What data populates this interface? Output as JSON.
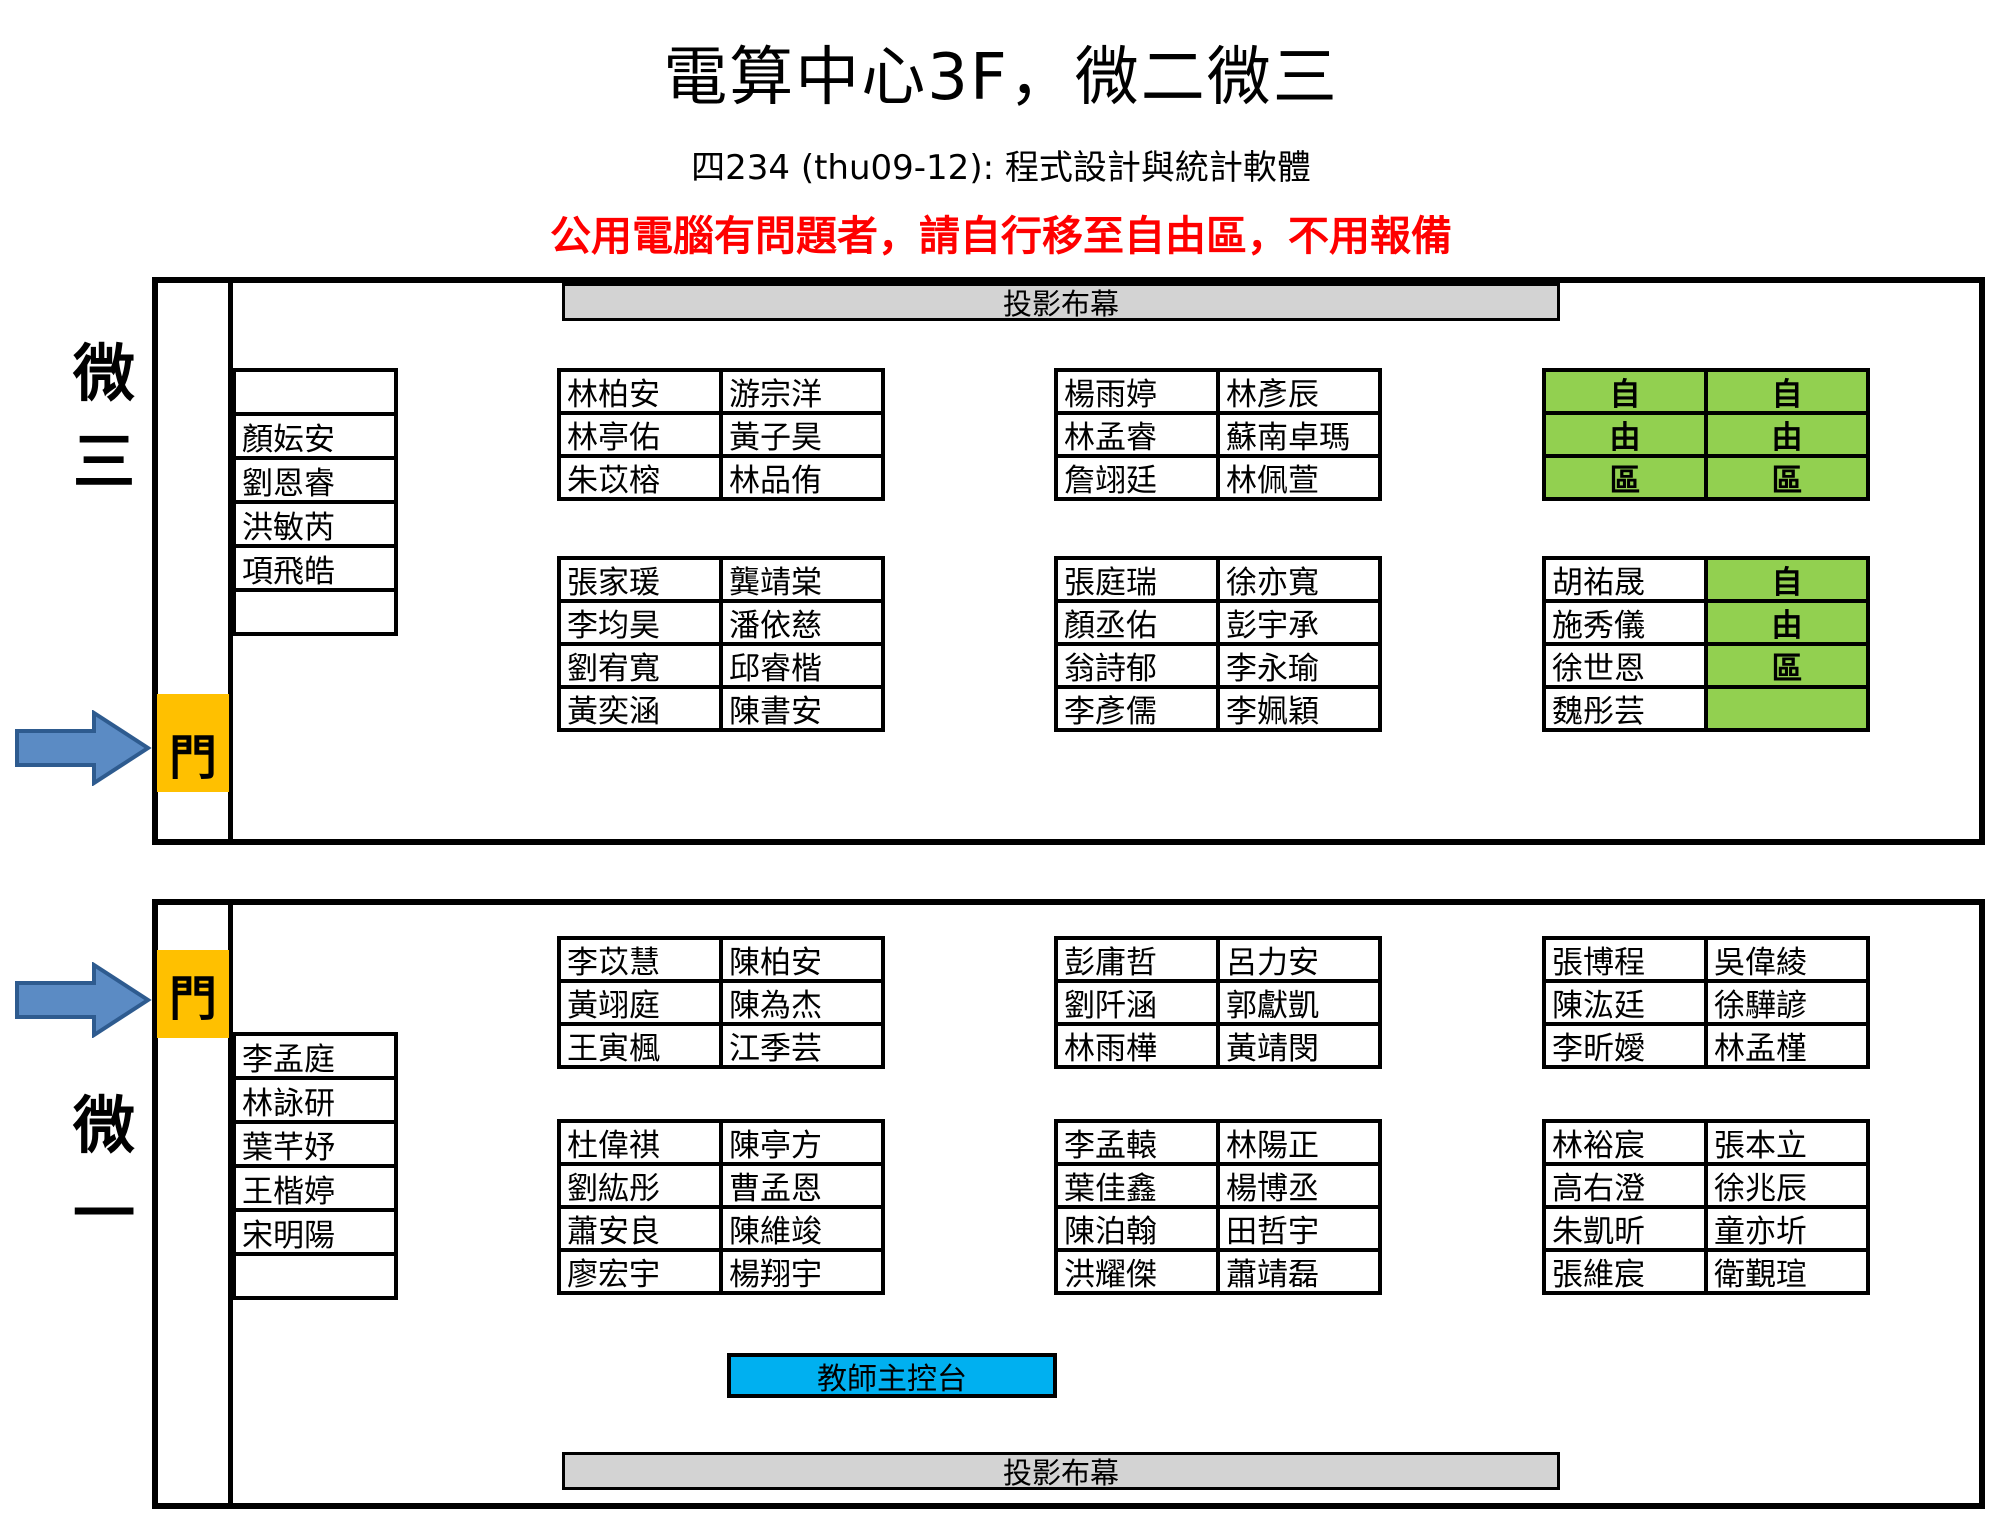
{
  "header": {
    "title": "電算中心3F，微二微三",
    "subtitle": "四234 (thu09-12): 程式設計與統計軟體",
    "notice": "公用電腦有問題者，請自行移至自由區，不用報備"
  },
  "labels": {
    "screen": "投影布幕",
    "door": "門",
    "console": "教師主控台",
    "room_top": "微三",
    "room_bottom": "微一"
  },
  "colors": {
    "free_area_green": "#92D050",
    "door_orange": "#FFC000",
    "console_blue": "#00B0F0",
    "screen_gray": "#D3D3D3",
    "notice_red": "#FF0000",
    "arrow_fill_blue": "#5B8BC4",
    "arrow_border_blue": "#2E5B8F"
  },
  "room_top": {
    "name": "微三",
    "left_column": [
      "",
      "顏妘安",
      "劉恩睿",
      "洪敏芮",
      "項飛皓",
      ""
    ],
    "free_marks": {
      "front_right": "all",
      "back_right": "col2"
    },
    "blocks": {
      "front_left": [
        [
          "林柏安",
          "游宗洋"
        ],
        [
          "林亭佑",
          "黃子昊"
        ],
        [
          "朱苡榕",
          "林品侑"
        ]
      ],
      "front_middle": [
        [
          "楊雨婷",
          "林彥辰"
        ],
        [
          "林孟睿",
          "蘇南卓瑪"
        ],
        [
          "詹翊廷",
          "林佩萱"
        ]
      ],
      "front_right": [
        [
          "自",
          "自"
        ],
        [
          "由",
          "由"
        ],
        [
          "區",
          "區"
        ]
      ],
      "back_left": [
        [
          "張家瑗",
          "龔靖棠"
        ],
        [
          "李均昊",
          "潘依慈"
        ],
        [
          "劉宥寬",
          "邱睿楷"
        ],
        [
          "黃奕涵",
          "陳書安"
        ]
      ],
      "back_middle": [
        [
          "張庭瑞",
          "徐亦寬"
        ],
        [
          "顏丞佑",
          "彭宇承"
        ],
        [
          "翁詩郁",
          "李永瑜"
        ],
        [
          "李彥儒",
          "李姵穎"
        ]
      ],
      "back_right": [
        [
          "胡祐晟",
          "自"
        ],
        [
          "施秀儀",
          "由"
        ],
        [
          "徐世恩",
          "區"
        ],
        [
          "魏彤芸",
          ""
        ]
      ]
    }
  },
  "room_bottom": {
    "name": "微一",
    "left_column": [
      "李孟庭",
      "林詠研",
      "葉芊妤",
      "王楷婷",
      "宋明陽",
      ""
    ],
    "free_marks": {},
    "blocks": {
      "front_left": [
        [
          "李苡慧",
          "陳柏安"
        ],
        [
          "黃翊庭",
          "陳為杰"
        ],
        [
          "王寅楓",
          "江季芸"
        ]
      ],
      "front_middle": [
        [
          "彭庸哲",
          "呂力安"
        ],
        [
          "劉阡涵",
          "郭獻凱"
        ],
        [
          "林雨樺",
          "黃靖閔"
        ]
      ],
      "front_right": [
        [
          "張博程",
          "吳偉綾"
        ],
        [
          "陳汯廷",
          "徐驊諺"
        ],
        [
          "李昕嬡",
          "林孟槿"
        ]
      ],
      "back_left": [
        [
          "杜偉祺",
          "陳亭方"
        ],
        [
          "劉紘彤",
          "曹孟恩"
        ],
        [
          "蕭安良",
          "陳維竣"
        ],
        [
          "廖宏宇",
          "楊翔宇"
        ]
      ],
      "back_middle": [
        [
          "李孟轅",
          "林陽正"
        ],
        [
          "葉佳鑫",
          "楊博丞"
        ],
        [
          "陳泊翰",
          "田哲宇"
        ],
        [
          "洪耀傑",
          "蕭靖磊"
        ]
      ],
      "back_right": [
        [
          "林裕宸",
          "張本立"
        ],
        [
          "高右澄",
          "徐兆辰"
        ],
        [
          "朱凱昕",
          "童亦圻"
        ],
        [
          "張維宸",
          "衛覲瑄"
        ]
      ]
    }
  }
}
